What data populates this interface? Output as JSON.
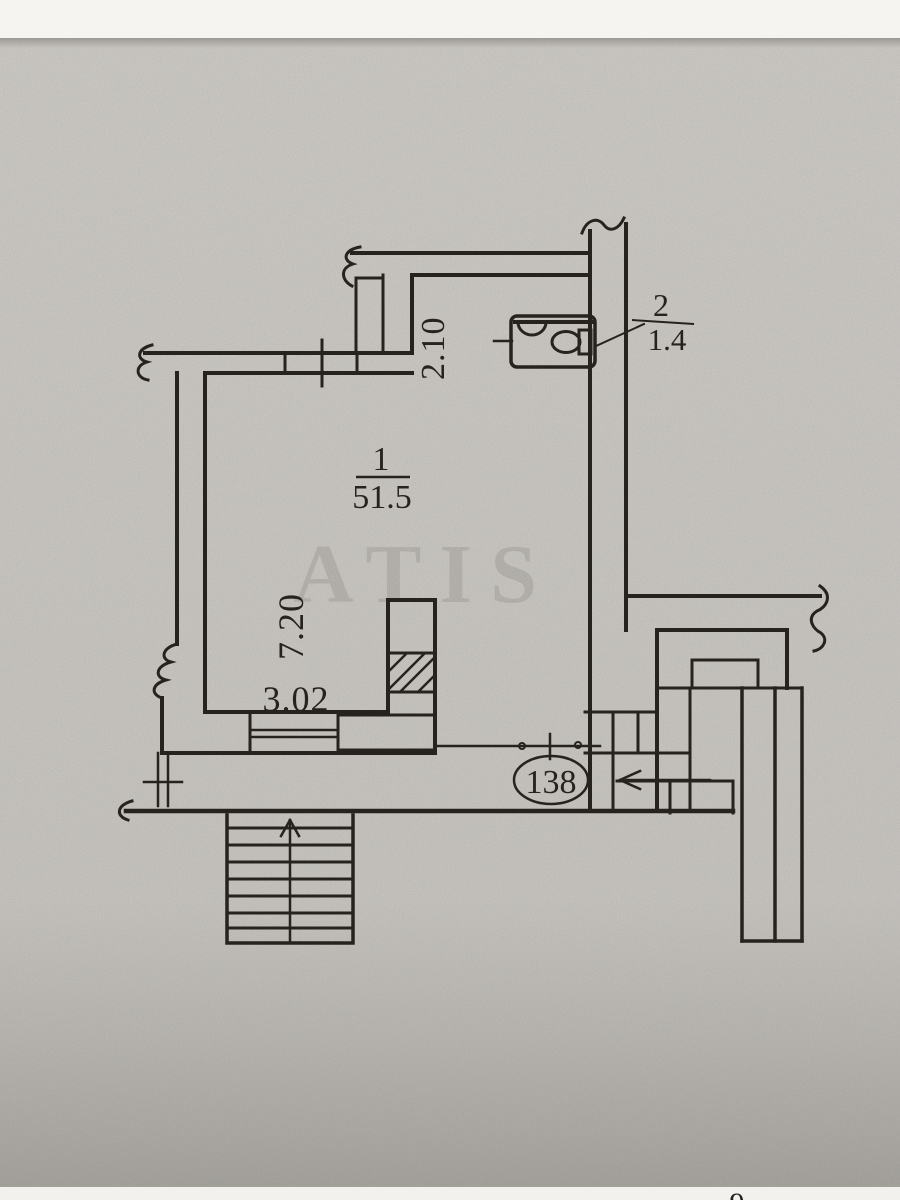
{
  "document": {
    "kind": "scanned floor plan page",
    "watermark": "ATIS",
    "page_fragment_digit": "9"
  },
  "rooms": [
    {
      "number": "1",
      "area": "51.5"
    },
    {
      "number": "2",
      "area": "1.4"
    }
  ],
  "dimensions": {
    "top_corridor_width": "2.10",
    "left_wall_length": "7.20",
    "bottom_segment_width": "3.02"
  },
  "unit_number": "138",
  "colors": {
    "ink": "#26231f",
    "paper": "#c7c4bf",
    "paper_dark": "#8f8c87",
    "band_white": "#f5f4f0"
  }
}
